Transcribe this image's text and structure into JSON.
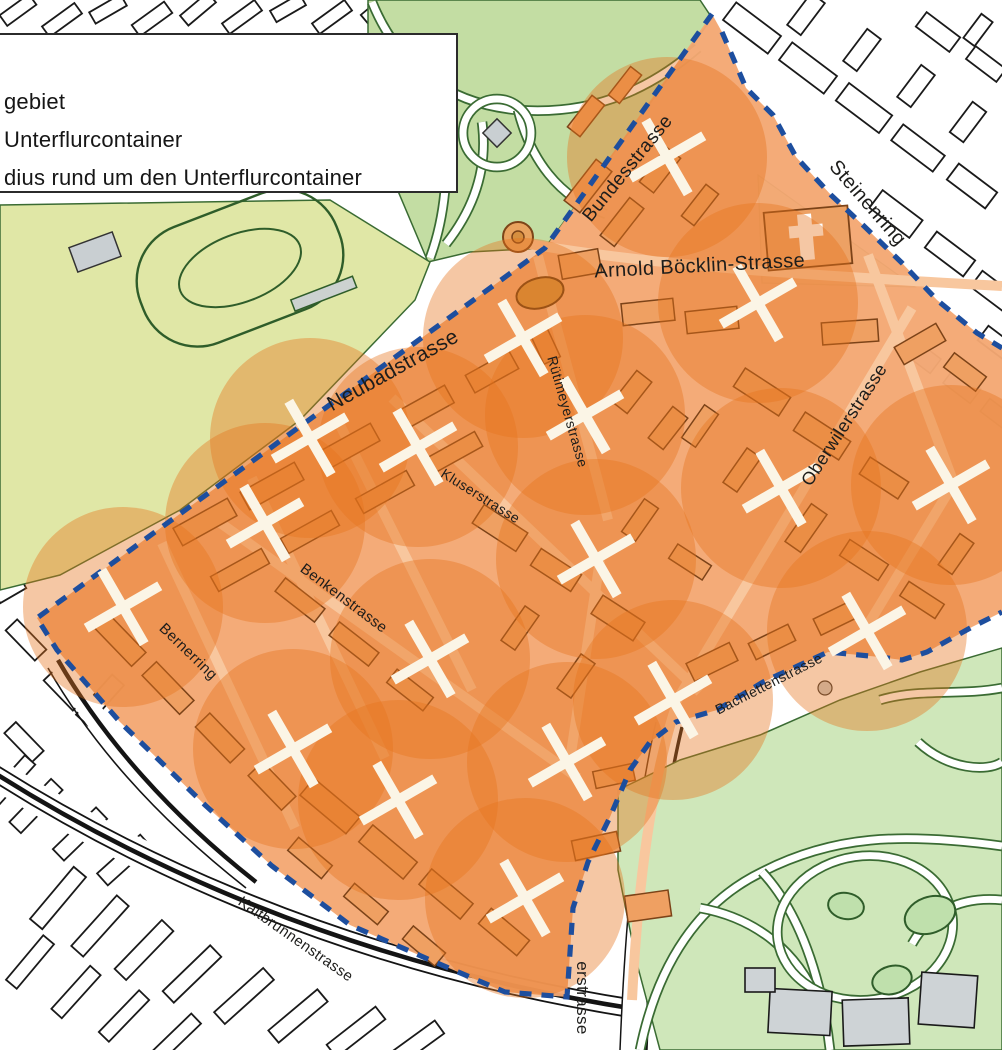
{
  "legend": {
    "items": [
      {
        "label": "gebiet"
      },
      {
        "label": "Unterflurcontainer"
      },
      {
        "label": "dius rund um den Unterflurcontainer"
      }
    ]
  },
  "map": {
    "street_labels": [
      {
        "name": "Bundesstrasse",
        "x": 632,
        "y": 172,
        "rotate": -51,
        "size": 19
      },
      {
        "name": "Steinenring",
        "x": 863,
        "y": 207,
        "rotate": 49,
        "size": 20
      },
      {
        "name": "Arnold Böcklin-Strasse",
        "x": 700,
        "y": 272,
        "rotate": -3,
        "size": 20
      },
      {
        "name": "Neubadstrasse",
        "x": 396,
        "y": 376,
        "rotate": -29,
        "size": 21
      },
      {
        "name": "Rütimeyerstrasse",
        "x": 563,
        "y": 413,
        "rotate": 74,
        "size": 14
      },
      {
        "name": "Kluserstrasse",
        "x": 478,
        "y": 500,
        "rotate": 32,
        "size": 14
      },
      {
        "name": "Oberwilerstrasse",
        "x": 849,
        "y": 428,
        "rotate": -57,
        "size": 18
      },
      {
        "name": "Benkenstrasse",
        "x": 341,
        "y": 602,
        "rotate": 37,
        "size": 15
      },
      {
        "name": "Bernerring",
        "x": 185,
        "y": 655,
        "rotate": 44,
        "size": 15
      },
      {
        "name": "Bachlettenstrasse",
        "x": 771,
        "y": 688,
        "rotate": -27,
        "size": 14
      },
      {
        "name": "Kaltbrunnenstrasse",
        "x": 293,
        "y": 943,
        "rotate": 35,
        "size": 15
      },
      {
        "name": "erstrasse",
        "x": 577,
        "y": 998,
        "rotate": 90,
        "size": 17
      }
    ],
    "containers": [
      [
        667,
        157
      ],
      [
        523,
        338
      ],
      [
        758,
        303
      ],
      [
        585,
        415
      ],
      [
        310,
        438
      ],
      [
        418,
        447
      ],
      [
        265,
        523
      ],
      [
        123,
        607
      ],
      [
        430,
        659
      ],
      [
        781,
        488
      ],
      [
        951,
        485
      ],
      [
        596,
        559
      ],
      [
        867,
        631
      ],
      [
        673,
        700
      ],
      [
        293,
        749
      ],
      [
        398,
        800
      ],
      [
        567,
        762
      ],
      [
        525,
        898
      ]
    ],
    "radius_px": 100,
    "boundary": {
      "main": [
        [
          712,
          14
        ],
        [
          545,
          248
        ],
        [
          37,
          618
        ],
        [
          57,
          650
        ],
        [
          120,
          722
        ],
        [
          205,
          805
        ],
        [
          272,
          866
        ],
        [
          350,
          925
        ],
        [
          437,
          963
        ],
        [
          505,
          992
        ],
        [
          567,
          997
        ],
        [
          573,
          908
        ],
        [
          588,
          862
        ],
        [
          610,
          817
        ],
        [
          630,
          770
        ],
        [
          650,
          742
        ],
        [
          676,
          722
        ],
        [
          717,
          710
        ],
        [
          763,
          682
        ],
        [
          828,
          652
        ],
        [
          880,
          657
        ],
        [
          902,
          660
        ],
        [
          927,
          652
        ],
        [
          972,
          627
        ],
        [
          1002,
          612
        ]
      ],
      "steinenring": [
        [
          722,
          32
        ],
        [
          746,
          88
        ],
        [
          773,
          115
        ],
        [
          796,
          157
        ],
        [
          831,
          195
        ],
        [
          865,
          227
        ],
        [
          902,
          263
        ],
        [
          937,
          300
        ],
        [
          977,
          333
        ],
        [
          1002,
          348
        ]
      ]
    },
    "colors": {
      "pilot_fill": "#f4a873",
      "circle": "#e5741c",
      "boundary": "#1d4e9e",
      "marker": "#fbf5e6",
      "park_green": "#c3dda3",
      "park_yellow": "#e0e7a6",
      "zoo_green": "#cfe7ba",
      "label_text": "#1d1d1b"
    }
  }
}
